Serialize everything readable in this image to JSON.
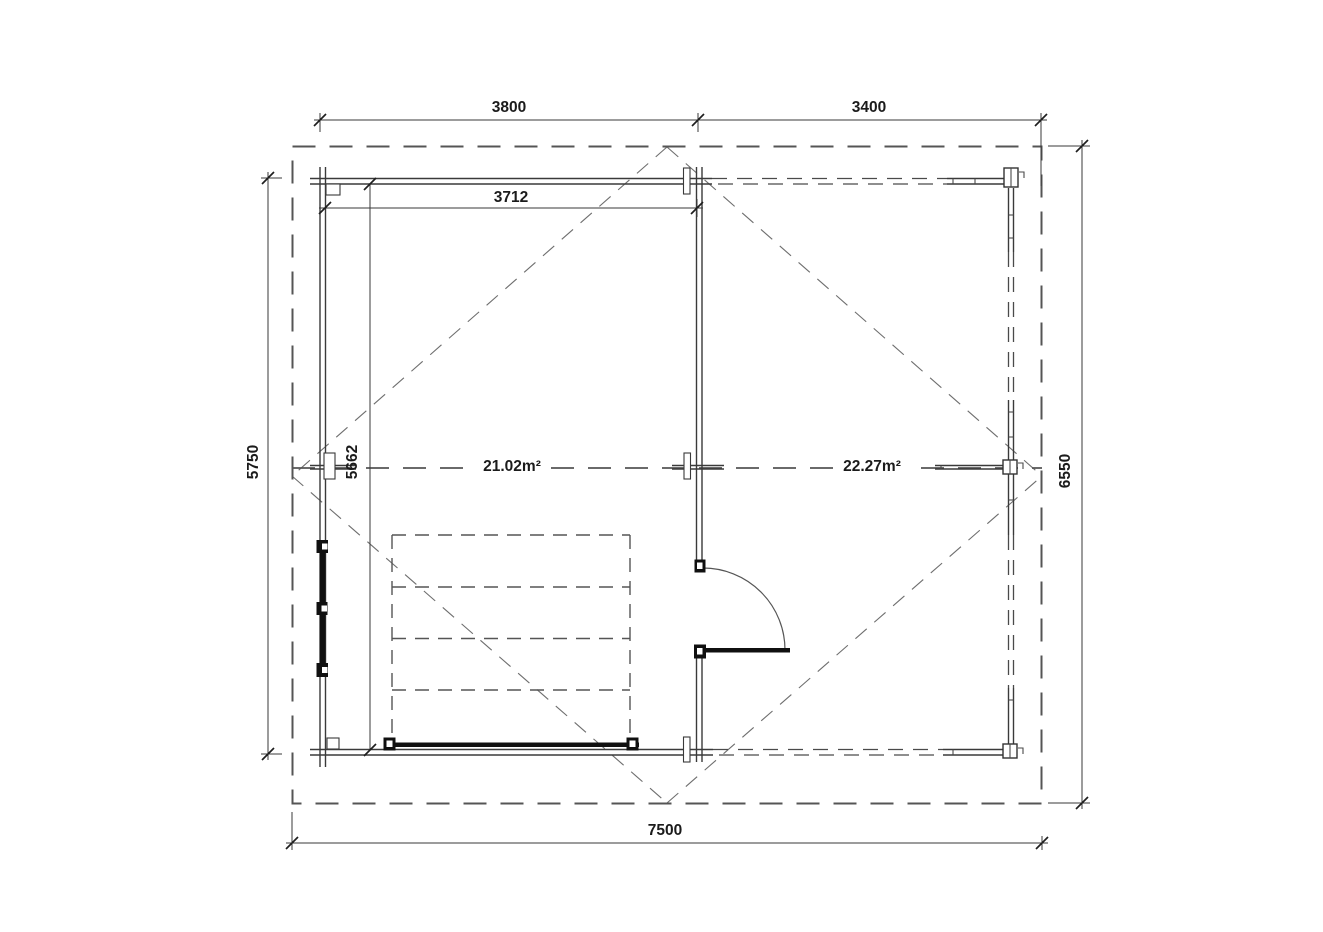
{
  "plan": {
    "dimensions": {
      "top_width_left": "3800",
      "top_width_right": "3400",
      "interior_width": "3712",
      "interior_height": "5662",
      "left_exterior_height": "5750",
      "right_overall_height": "6550",
      "bottom_overall_width": "7500"
    },
    "rooms": {
      "left_room_area": "21.02m²",
      "right_room_area": "22.27m²"
    },
    "colors": {
      "wall_line": "#3a3a3a",
      "dashed_line": "#555555",
      "glazing_black": "#101010",
      "text": "#1b1b1b",
      "background": "#ffffff"
    }
  }
}
